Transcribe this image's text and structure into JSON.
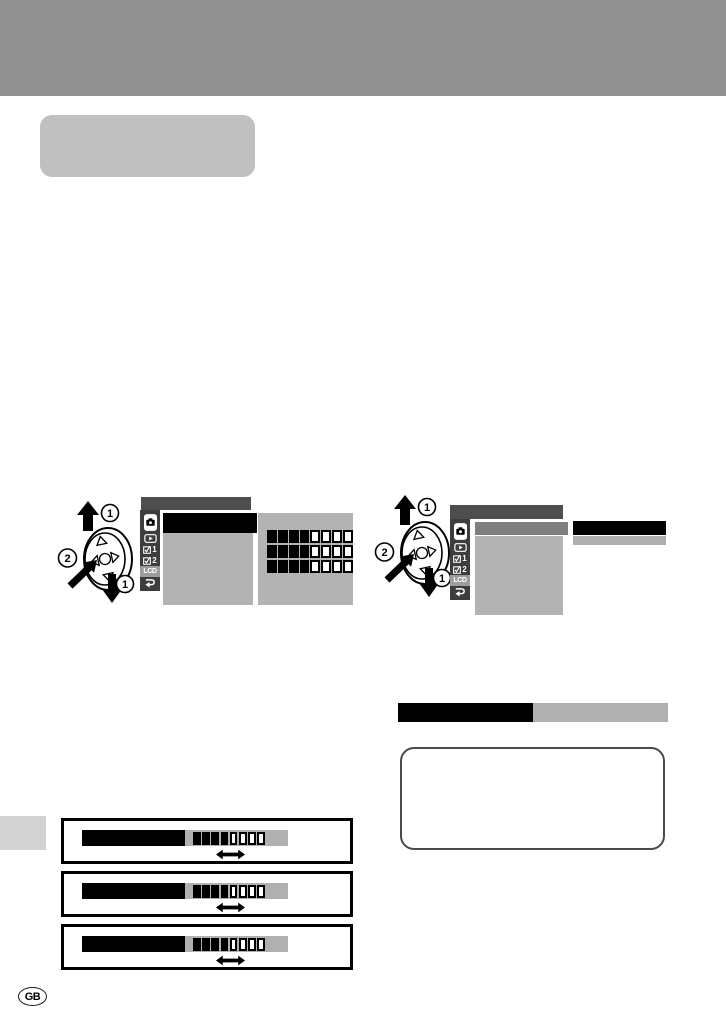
{
  "page": {
    "language_badge": "GB"
  },
  "colors": {
    "header_bar": "#909090",
    "title_pill": "#c0c0c0",
    "menu_topbar": "#4d4d4d",
    "menu_sidebar": "#3d3d3d",
    "sidebar_highlight": "#9c9c9c",
    "screen_gray": "#b3b3b3",
    "selected_gray": "#7f7f7f",
    "subbar_gray": "#aeaeae",
    "level_gray": "#b0b0b0",
    "margin_tab": "#d2d2d2",
    "note_border": "#4a4a4a"
  },
  "nav_pad": {
    "scroll_label": "1",
    "press_label": "2"
  },
  "menu_tabs": [
    {
      "id": "shooting",
      "icon": "camera-icon",
      "label": ""
    },
    {
      "id": "playback",
      "icon": "play-icon",
      "label": ""
    },
    {
      "id": "settings-1",
      "icon": "checkbox-icon",
      "label": "1"
    },
    {
      "id": "settings-2",
      "icon": "checkbox-icon",
      "label": "2"
    },
    {
      "id": "lcd",
      "icon": "lcd-text",
      "label": "LCD",
      "highlighted": true
    },
    {
      "id": "return",
      "icon": "return-arrow-icon",
      "label": ""
    }
  ],
  "screens": {
    "left": {
      "selected_row_style": "black",
      "levels": [
        {
          "filled": 4,
          "total": 8
        },
        {
          "filled": 4,
          "total": 8
        },
        {
          "filled": 4,
          "total": 8
        }
      ]
    },
    "right": {
      "selected_row_style": "gray",
      "value_bar_style": "black",
      "value_subbar_style": "gray"
    }
  },
  "section_bar": {
    "left_style": "black",
    "right_style": "gray"
  },
  "setting_boxes": [
    {
      "level": {
        "filled": 4,
        "total": 8
      }
    },
    {
      "level": {
        "filled": 4,
        "total": 8
      }
    },
    {
      "level": {
        "filled": 4,
        "total": 8
      }
    }
  ]
}
